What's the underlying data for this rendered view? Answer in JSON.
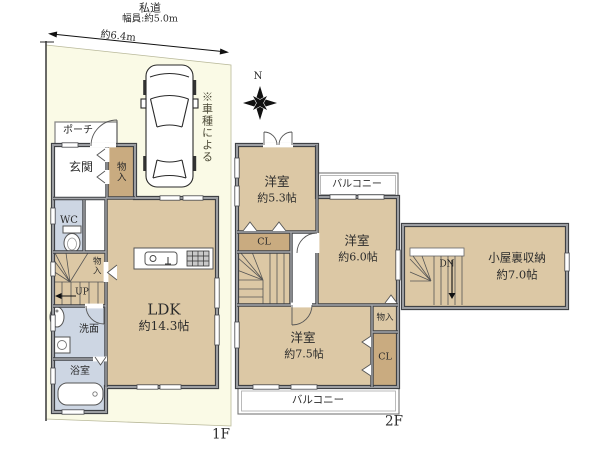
{
  "site": {
    "road_label": "私道",
    "road_width": "幅員:約5.0m",
    "frontage_dim": "約6.4m",
    "car_note": "※車種による",
    "compass_north": "N",
    "floor1_label": "1F",
    "floor2_label": "2F"
  },
  "floor1": {
    "porch": "ポーチ",
    "entrance": "玄関",
    "entrance_closet": "物入",
    "wc": "WC",
    "stairs_closet": "物入",
    "stairs_up": "UP",
    "washroom": "洗面",
    "bathroom": "浴室",
    "ldk_name": "LDK",
    "ldk_size": "約14.3帖"
  },
  "floor2": {
    "room_small_name": "洋室",
    "room_small_size": "約5.3帖",
    "balcony_top": "バルコニー",
    "room_mid_name": "洋室",
    "room_mid_size": "約6.0帖",
    "closet_left": "CL",
    "room_large_name": "洋室",
    "room_large_size": "約7.5帖",
    "storage": "物入",
    "closet_right": "CL",
    "balcony_bottom": "バルコニー"
  },
  "attic": {
    "stairs_dn": "DN",
    "name": "小屋裏収納",
    "size": "約7.0帖"
  },
  "colors": {
    "plot": "#fafae6",
    "room_tan": "#dcc8a5",
    "closet_brown": "#c9ab80",
    "wet_blue": "#cdd6e3",
    "wall_gray": "#3f4145"
  }
}
